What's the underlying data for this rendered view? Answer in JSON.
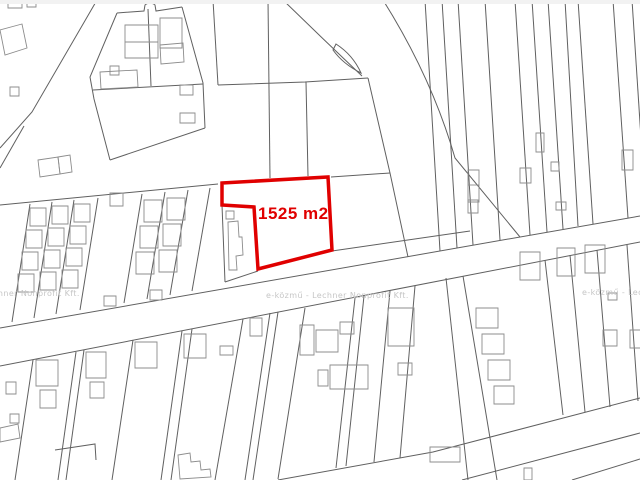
{
  "map": {
    "type": "cadastral_parcel_map",
    "canvas": {
      "width": 640,
      "height": 480,
      "background": "#ffffff",
      "top_band_color": "#f2f2f2"
    },
    "colors": {
      "parcel_line": "#606060",
      "building_line": "#8c8c8c",
      "highlight": "#e00000",
      "watermark": "#c6c6c6"
    },
    "watermark": {
      "text": "e-közmű - Lechner Nonprofit Kft.",
      "font_size": 8,
      "instances": [
        {
          "x": -63,
          "y": 289
        },
        {
          "x": 266,
          "y": 291
        },
        {
          "x": 582,
          "y": 288
        }
      ]
    },
    "highlight": {
      "path": "M 222 183 L 328 177 L 332 250 L 258 269 L 254 207 L 222 205 Z",
      "stroke_width": 3.5,
      "fill": "#ffffff",
      "label": {
        "text": "1525 m2",
        "x": 258,
        "y": 204
      }
    },
    "parcel_paths": [
      "M 97 0 L 32 112 L 0 148",
      "M 24 126 L 0 168",
      "M 0 205 L 218 184",
      "M 0 328 L 640 216",
      "M 0 366 L 640 242",
      "M 332 251 L 470 231",
      "M 278 480 L 433 452 L 640 398",
      "M 462 480 L 640 433",
      "M 572 480 L 640 459",
      "M 446 278 L 468 480",
      "M 463 276 L 497 480",
      "M 283 0 Q 322 38 362 76",
      "M 383 0 Q 432 78 455 158 L 520 237",
      "M 336 44 Q 353 55 361 73 Q 343 64 333 50 Z",
      "M 218 85 L 305 82 L 368 78",
      "M 213 0 L 218 85",
      "M 268 0 L 270 178",
      "M 306 82 L 308 176",
      "M 368 78 L 390 173 L 408 257",
      "M 331 177 L 390 173",
      "M 117 13 L 90 77 L 94 99 L 110 160",
      "M 110 160 L 205 128",
      "M 117 13 L 144 11 L 145 5 Q 150 1 155 5 L 156 11 L 182 7",
      "M 182 7 L 203 83 L 205 128",
      "M 93 90 L 203 84",
      "M 148 9 L 151 86",
      "M 30 204 L 12 322",
      "M 52 202 L 34 318",
      "M 74 200 L 56 314",
      "M 98 198 L 80 310",
      "M 142 194 L 124 303",
      "M 165 192 L 147 299",
      "M 188 190 L 170 295",
      "M 210 188 L 192 291",
      "M 425 0 L 440 251",
      "M 442 0 L 457 248",
      "M 458 0 L 473 245",
      "M 485 0 L 500 240",
      "M 515 0 L 530 235",
      "M 532 0 L 547 232",
      "M 548 0 L 563 229",
      "M 565 0 L 578 226",
      "M 578 0 L 593 224",
      "M 613 0 L 628 218",
      "M 632 0 L 646 215",
      "M 33 360 L 15 480",
      "M 76 352 L 58 480",
      "M 84 350 L 66 480",
      "M 133 340 L 112 480",
      "M 182 331 L 161 480",
      "M 192 329 L 171 480",
      "M 243 319 L 215 480",
      "M 270 313 L 245 480",
      "M 278 312 L 253 480",
      "M 305 308 L 278 479",
      "M 355 298 L 336 468",
      "M 364 296 L 346 466",
      "M 390 291 L 374 462",
      "M 415 286 L 400 458",
      "M 545 260 L 563 415",
      "M 570 255 L 585 412",
      "M 597 250 L 610 407",
      "M 627 245 L 638 401",
      "M 222 205 L 225 282",
      "M 225 282 L 258 271",
      "M 55 450 L 95 444 L 96 460"
    ],
    "building_paths": [
      "M 8 0 h 14 v 8 h -14 Z",
      "M 27 0 h 9 v 7 h -9 Z",
      "M 0 30 L 22 24 L 27 48 L 5 55 Z",
      "M 10 87 h 9 v 9 h -9 Z",
      "M 38 160 L 58 157 L 60 174 L 40 177 Z",
      "M 58 157 L 70 155 L 72 172 L 60 174 Z",
      "M 125 25 h 33 v 33 h -33 Z",
      "M 125 42 h 33",
      "M 160 18 h 22 v 30 h -22 Z",
      "M 100 72 L 137 70 L 138 87 L 101 89 Z",
      "M 160 45 L 183 43 L 184 62 L 161 64 Z",
      "M 110 66 h 9 v 9 h -9 Z",
      "M 180 85 h 13 v 10 h -13 Z",
      "M 180 113 h 15 v 10 h -15 Z",
      "M 30 208 h 16 v 18 h -16 Z",
      "M 26 230 h 16 v 18 h -16 Z",
      "M 22 252 h 16 v 18 h -16 Z",
      "M 18 274 h 16 v 18 h -16 Z",
      "M 52 206 h 16 v 18 h -16 Z",
      "M 48 228 h 16 v 18 h -16 Z",
      "M 44 250 h 16 v 18 h -16 Z",
      "M 40 272 h 16 v 18 h -16 Z",
      "M 74 204 h 16 v 18 h -16 Z",
      "M 70 226 h 16 v 18 h -16 Z",
      "M 66 248 h 16 v 18 h -16 Z",
      "M 62 270 h 16 v 18 h -16 Z",
      "M 144 200 h 18 v 22 h -18 Z",
      "M 140 226 h 18 v 22 h -18 Z",
      "M 136 252 h 18 v 22 h -18 Z",
      "M 167 198 h 18 v 22 h -18 Z",
      "M 163 224 h 18 v 22 h -18 Z",
      "M 159 250 h 18 v 22 h -18 Z",
      "M 110 193 h 13 v 13 h -13 Z",
      "M 104 296 h 12 v 10 h -12 Z",
      "M 150 290 h 12 v 10 h -12 Z",
      "M 468 170 h 11 v 32 h -11 Z",
      "M 468 185 h 11",
      "M 520 168 h 11 v 15 h -11 Z",
      "M 536 133 h 8 v 19 h -8 Z",
      "M 551 162 h 8 v 9 h -8 Z",
      "M 622 150 h 11 v 20 h -11 Z",
      "M 468 200 h 10 v 13 h -10 Z",
      "M 556 202 h 10 v 8 h -10 Z",
      "M 226 211 h 8 v 8 h -8 Z",
      "M 228 222 L 238 221 L 239 237 L 242 237 L 243 255 L 236 256 L 237 270 L 229 270 Z",
      "M 36 360 h 22 v 26 h -22 Z",
      "M 40 390 h 16 v 18 h -16 Z",
      "M 86 352 h 20 v 26 h -20 Z",
      "M 90 382 h 14 v 16 h -14 Z",
      "M 135 342 h 22 v 26 h -22 Z",
      "M 184 334 h 22 v 24 h -22 Z",
      "M 220 346 h 13 v 9 h -13 Z",
      "M 6 382 h 10 v 12 h -10 Z",
      "M 10 414 h 9 v 9 h -9 Z",
      "M 0 428 L 18 424 L 20 438 L 0 442 Z",
      "M 300 325 h 14 v 30 h -14 Z",
      "M 316 330 h 22 v 22 h -22 Z",
      "M 340 322 h 14 v 12 h -14 Z",
      "M 330 365 h 38 v 24 h -38 Z",
      "M 318 370 h 10 v 16 h -10 Z",
      "M 388 308 h 26 v 38 h -26 Z",
      "M 398 363 h 14 v 12 h -14 Z",
      "M 250 318 h 12 v 18 h -12 Z",
      "M 520 252 h 20 v 28 h -20 Z",
      "M 557 248 h 18 v 28 h -18 Z",
      "M 585 245 h 20 v 28 h -20 Z",
      "M 476 308 h 22 v 20 h -22 Z",
      "M 482 334 h 22 v 20 h -22 Z",
      "M 488 360 h 22 v 20 h -22 Z",
      "M 494 386 h 20 v 18 h -20 Z",
      "M 603 330 h 14 v 16 h -14 Z",
      "M 630 330 h 12 v 18 h -12 Z",
      "M 608 293 h 9 v 7 h -9 Z",
      "M 430 447 h 30 v 15 h -30 Z",
      "M 524 468 h 8 v 12 h -8 Z",
      "M 178 455 L 190 453 L 191 462 L 200 461 L 201 470 L 210 469 L 211 477 L 180 479 Z"
    ]
  }
}
